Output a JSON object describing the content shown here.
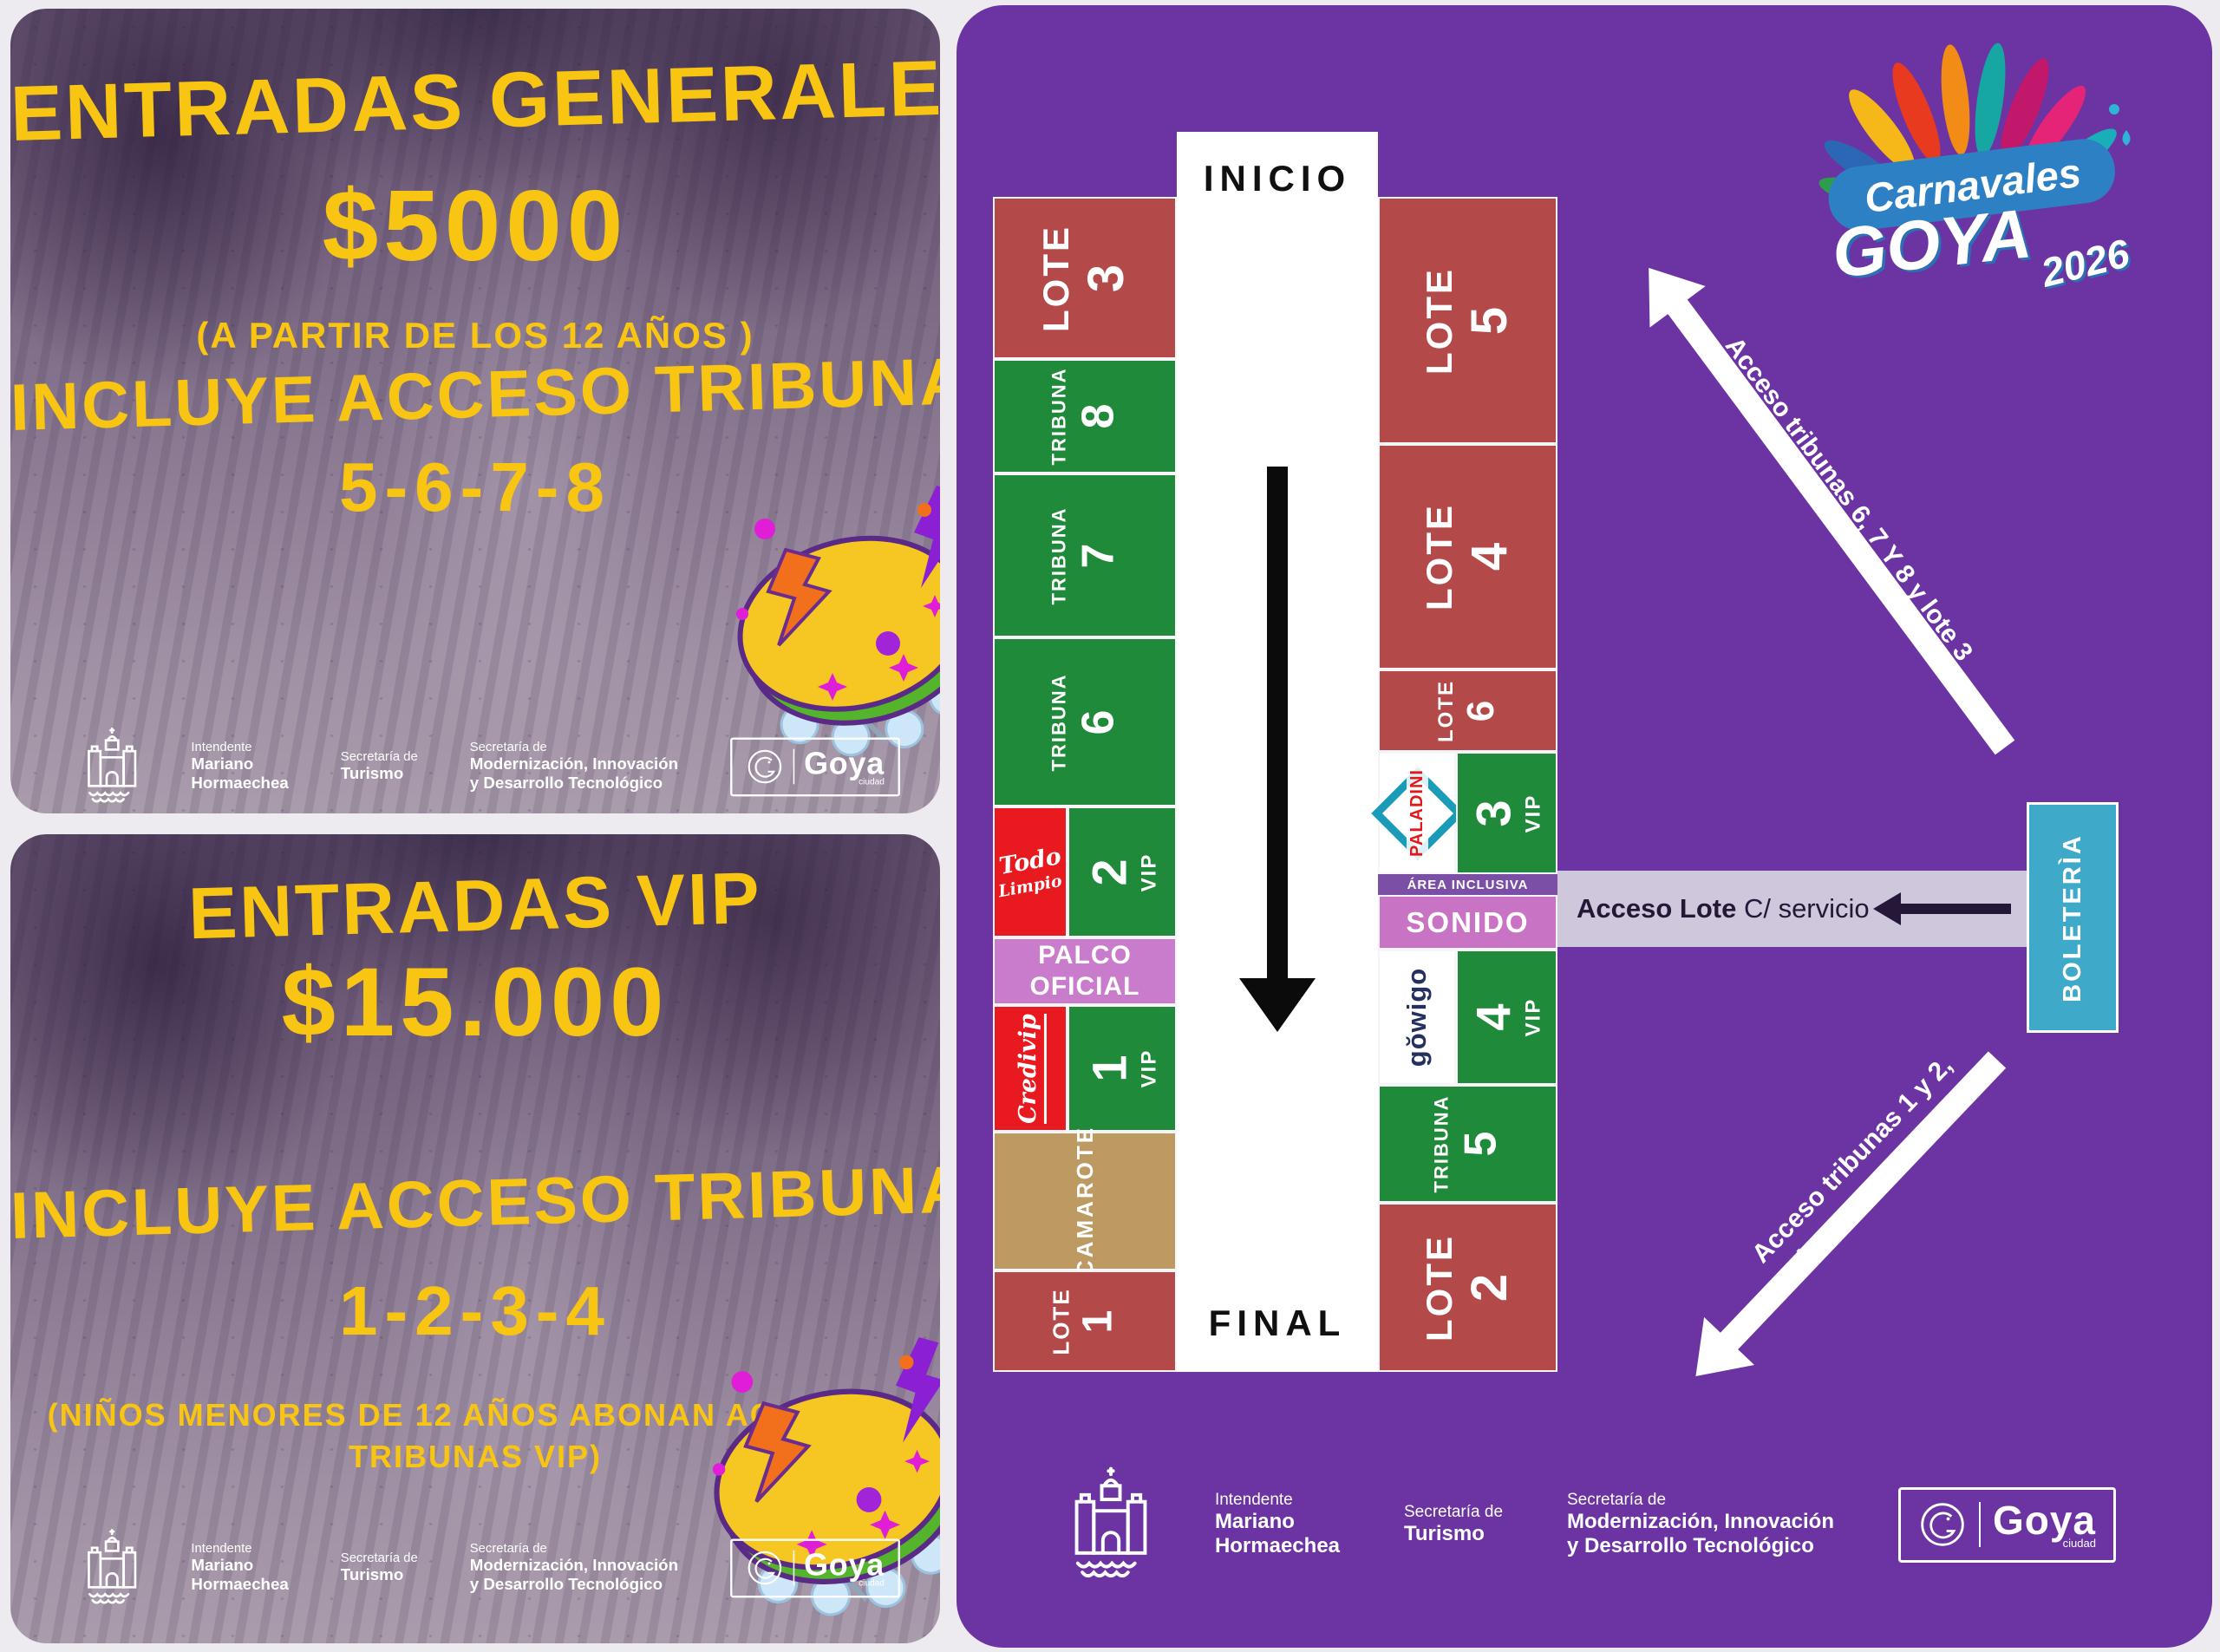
{
  "colors": {
    "panel_purple": "#6B34A2",
    "lote_red": "#B4494A",
    "tribuna_green": "#1F8A39",
    "sponsor_red": "#E8191F",
    "palco_pink": "#C97CCB",
    "sonido_pink": "#C873C3",
    "area_inclusiva_purple": "#7B4FA5",
    "corridor_lavender": "#CFC7DB",
    "boleteria_blue": "#3FA9C9",
    "camarote_tan": "#BE9A63",
    "headline_yellow": "#F9C513",
    "corridor_arrow_dark": "#241737"
  },
  "poster_general": {
    "title": "ENTRADAS GENERALES",
    "price": "$5000",
    "age_note": "(A PARTIR DE LOS 12 AÑOS )",
    "subtitle": "INCLUYE ACCESO TRIBUNAS",
    "tribunas": "5-6-7-8"
  },
  "poster_vip": {
    "title": "ENTRADAS VIP",
    "price": "$15.000",
    "subtitle": "INCLUYE ACCESO TRIBUNAS",
    "tribunas": "1-2-3-4",
    "kids_note_line1": "(NIÑOS MENORES DE 12 AÑOS ABONAN ACCESO A",
    "kids_note_line2": "TRIBUNAS VIP)"
  },
  "gov_footer": {
    "intendente_label": "Intendente",
    "intendente_line1": "Mariano",
    "intendente_line2": "Hormaechea",
    "secretaria_label": "Secretaría de",
    "turismo": "Turismo",
    "modernizacion_label": "Secretaría de",
    "modernizacion_line1": "Modernización, Innovación",
    "modernizacion_line2": "y Desarrollo Tecnológico",
    "goya": "Goya",
    "goya_sub": "ciudad"
  },
  "brand": {
    "carnavales": "Carnavales",
    "goya": "GOYA",
    "year": "2026"
  },
  "map": {
    "inicio": "INICIO",
    "final": "FINAL",
    "left": [
      {
        "word": "LOTE",
        "num": "3"
      },
      {
        "word": "TRIBUNA",
        "num": "8"
      },
      {
        "word": "TRIBUNA",
        "num": "7"
      },
      {
        "word": "TRIBUNA",
        "num": "6"
      },
      {
        "num": "2",
        "tier": "VIP"
      },
      {
        "line1": "PALCO",
        "line2": "OFICIAL"
      },
      {
        "num": "1",
        "tier": "VIP"
      },
      {
        "word": "CAMAROTE"
      },
      {
        "word": "LOTE",
        "num": "1"
      }
    ],
    "right": [
      {
        "word": "LOTE",
        "num": "5"
      },
      {
        "word": "LOTE",
        "num": "4"
      },
      {
        "word": "LOTE",
        "num": "6"
      },
      {
        "num": "3",
        "tier": "VIP"
      },
      {
        "label": "ÁREA INCLUSIVA"
      },
      {
        "label": "SONIDO"
      },
      {
        "num": "4",
        "tier": "VIP"
      },
      {
        "word": "TRIBUNA",
        "num": "5"
      },
      {
        "word": "LOTE",
        "num": "2"
      }
    ],
    "sponsors": {
      "todo_line1": "Todo",
      "todo_line2": "Limpio",
      "credivip": "Credivip",
      "paladini": "PALADINI",
      "gowigo": "gŏwigo"
    },
    "corridor": {
      "bold": "Acceso Lote",
      "rest": " C/ servicio"
    },
    "boleteria": "BOLETERÌA",
    "access_up": "Acceso tribunas 6, 7 Y 8 y lote 3",
    "access_down_line1": "Acceso tribunas 1 y 2,",
    "access_down_line2": "lote 1 y camarote"
  }
}
